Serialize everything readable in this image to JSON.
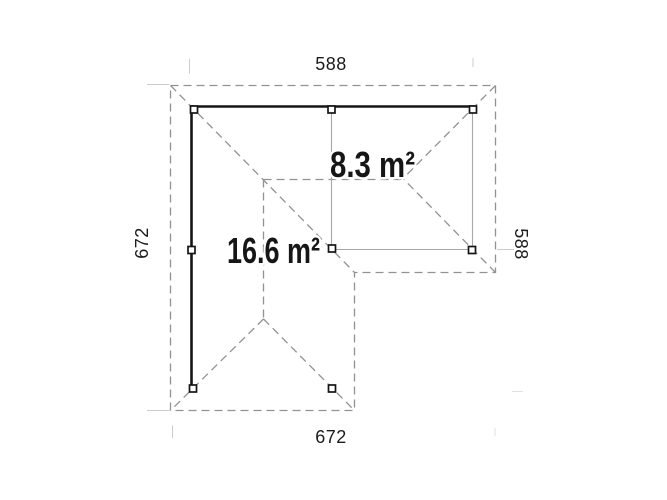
{
  "dimensions": {
    "top_width": "588",
    "bottom_width": "672",
    "left_height": "672",
    "right_height": "588"
  },
  "areas": {
    "main": "16.6 m²",
    "annex": "8.3 m²"
  },
  "colors": {
    "background": "#ffffff",
    "wall": "#151515",
    "frame_line": "#a8a8a8",
    "roof_edge_dashed": "#929292",
    "extension_line": "#cccccc",
    "text": "#1c1c1c"
  }
}
